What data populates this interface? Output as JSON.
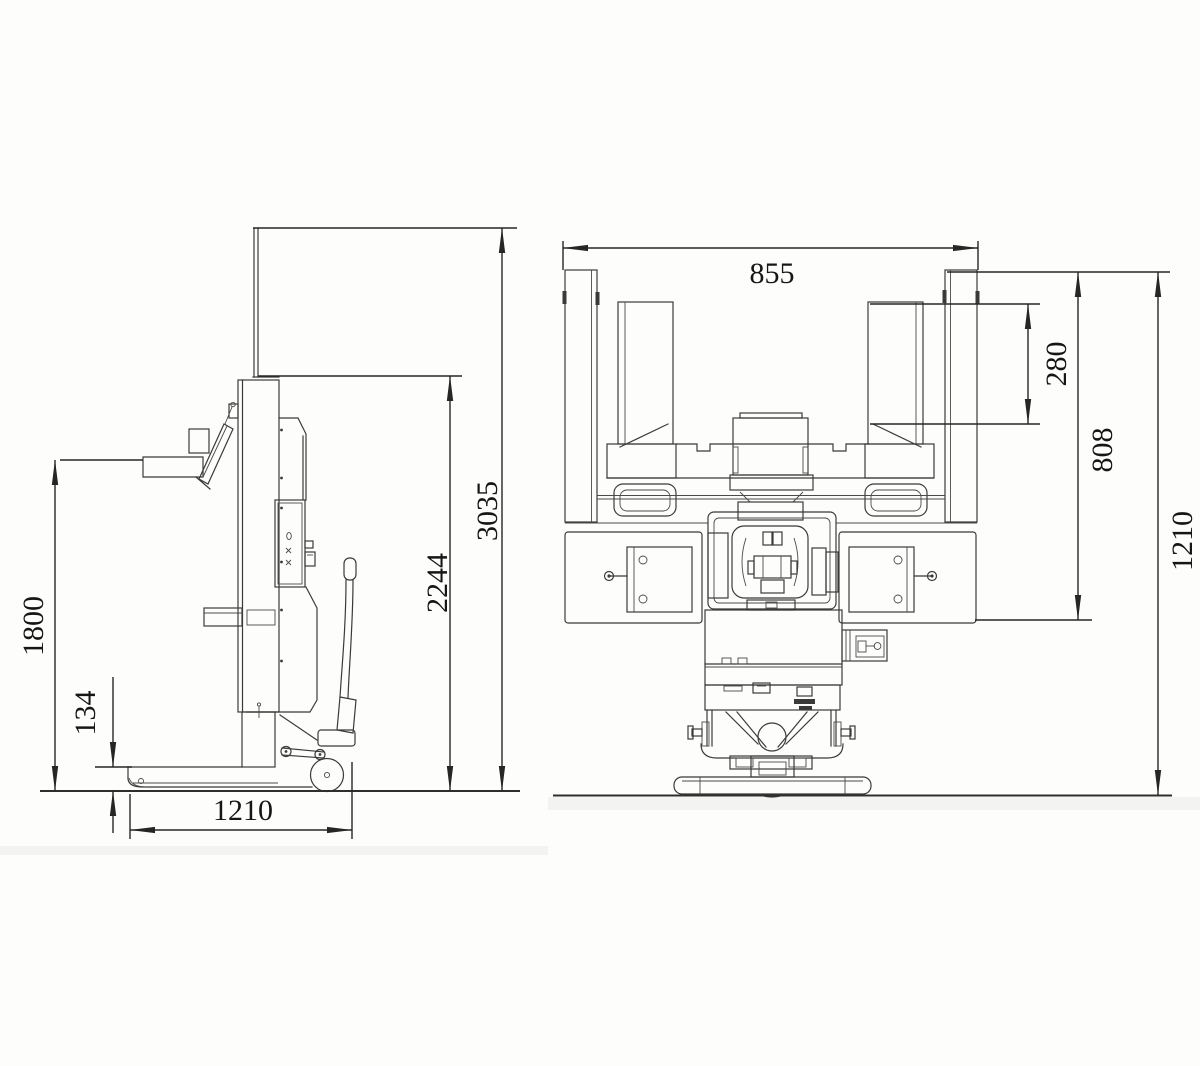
{
  "drawing": {
    "background": "#fdfdfc",
    "line_color": "#3a3a3a",
    "dimension_color": "#262626",
    "text_color": "#161616",
    "side_view": {
      "dimensions": {
        "overall_height_mast_raised": "3035",
        "mast_height": "2244",
        "platform_height": "1800",
        "fork_height": "134",
        "overall_length": "1210"
      }
    },
    "front_view": {
      "dimensions": {
        "fork_frame_width": "855",
        "fork_plate_height": "280",
        "frame_height": "808",
        "overall_height": "1210"
      }
    }
  }
}
